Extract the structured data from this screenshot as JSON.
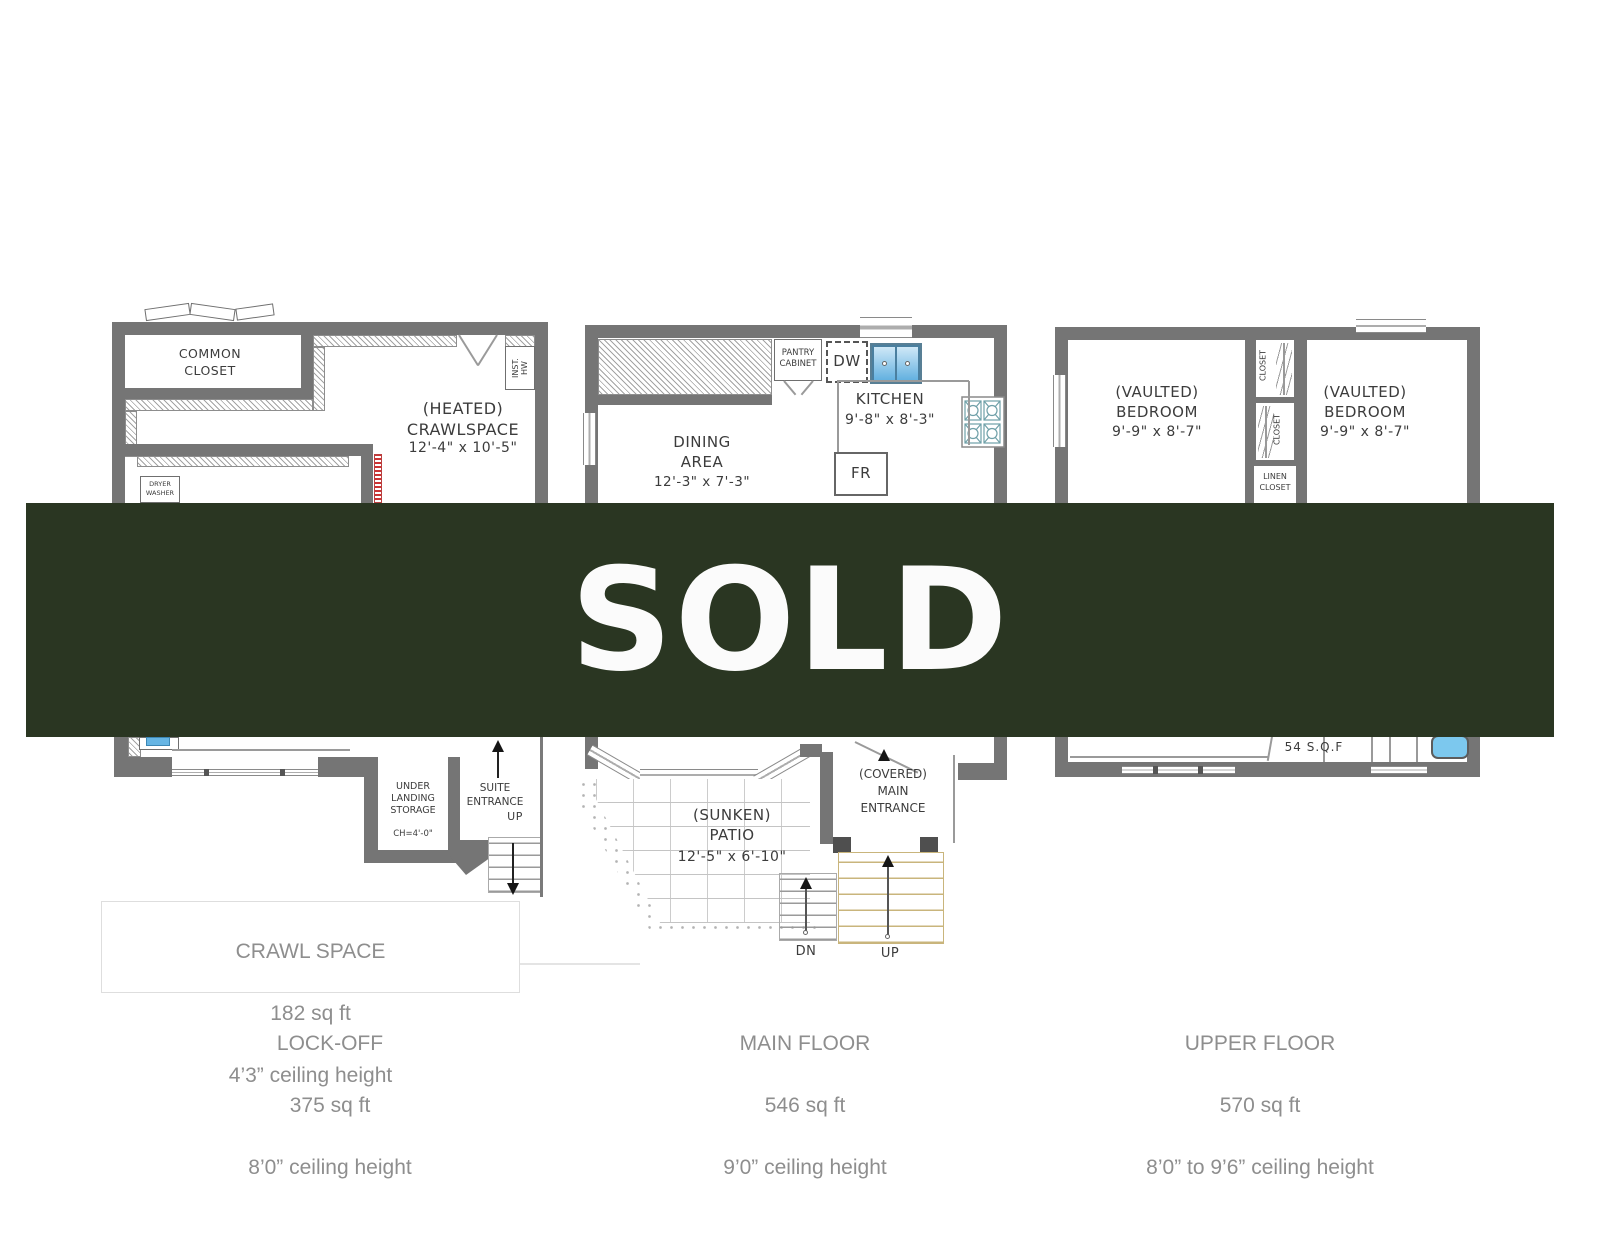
{
  "banner": {
    "text": "SOLD"
  },
  "colors": {
    "banner_bg": "#2a3622",
    "banner_fg": "#fbfbfb",
    "wall": "#757575",
    "caption": "#8e8e8e",
    "plan_text": "#3c3c3c",
    "sink": "#66b5e4",
    "tub": "#7cc8ee",
    "stair": "#c9b57c",
    "red": "#cc3333"
  },
  "plans": {
    "lockoff": {
      "common_closet": "COMMON\nCLOSET",
      "inst_hw": "INST.\nHW",
      "heated": "(HEATED)\nCRAWLSPACE",
      "heated_dims": "12'-4\" x 10'-5\"",
      "dryer_washer": "DRYER\nWASHER",
      "under_landing": "UNDER\nLANDING\nSTORAGE",
      "under_landing_ch": "CH=4'-0\"",
      "suite_entrance": "SUITE\nENTRANCE",
      "up": "UP"
    },
    "main": {
      "pantry": "PANTRY\nCABINET",
      "dw": "DW",
      "kitchen": "KITCHEN",
      "kitchen_dims": "9'-8\" x 8'-3\"",
      "fr": "FR",
      "dining": "DINING\nAREA",
      "dining_dims": "12'-3\" x 7'-3\"",
      "patio": "(SUNKEN)\nPATIO",
      "patio_dims": "12'-5\" x 6'-10\"",
      "entrance": "(COVERED)\nMAIN\nENTRANCE",
      "dn": "DN",
      "up": "UP"
    },
    "upper": {
      "bedroom": "(VAULTED)\nBEDROOM",
      "bedroom_dims": "9'-9\" x 8'-7\"",
      "closet": "CLOSET",
      "linen": "LINEN\nCLOSET",
      "sqf": "54 S.Q.F"
    }
  },
  "captions": {
    "crawl": {
      "title": "CRAWL SPACE",
      "area": "182 sq ft",
      "ceiling": "4’3” ceiling height"
    },
    "lockoff": {
      "title": "LOCK-OFF",
      "area": "375 sq ft",
      "ceiling": "8’0” ceiling height"
    },
    "main": {
      "title": "MAIN FLOOR",
      "area": "546 sq ft",
      "ceiling": "9’0” ceiling height"
    },
    "upper": {
      "title": "UPPER FLOOR",
      "area": "570 sq ft",
      "ceiling": "8’0” to 9’6” ceiling height"
    }
  }
}
